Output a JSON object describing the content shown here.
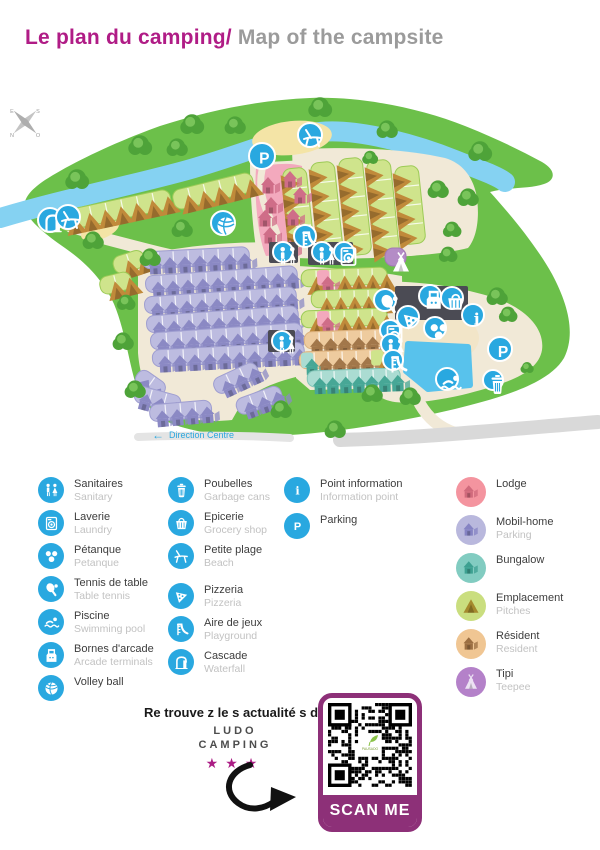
{
  "title": {
    "fr": "Le plan du camping/",
    "en": " Map of the campsite"
  },
  "colors": {
    "accent_blue": "#29a8e0",
    "land": "#6cc04a",
    "river": "#85d2f2",
    "path": "#f1e9d7",
    "sand": "#f4e4a6",
    "pool_sand": "#f2e5c8",
    "pool": "#58c2ec",
    "building": "#4b4b54",
    "road_gray": "#d9d9d9",
    "tree": "#4ea339",
    "tree_hi": "#79c45a",
    "title_magenta": "#b01c86",
    "title_gray": "#9b9b9b",
    "purple": "#8d3078",
    "star_magenta": "#ab1d85",
    "direction_blue": "#2ba7de"
  },
  "plot_types": {
    "pitch": {
      "fill": "#cfe48c",
      "stroke": "#9ccb56",
      "glyph": "#c08a3a",
      "sym": "tent"
    },
    "mobil": {
      "fill": "#bdbce0",
      "stroke": "#9f9ed0",
      "glyph": "#8b89c4",
      "sym": "house"
    },
    "lodge": {
      "fill": "#f3a9bd",
      "stroke": "#e58fa7",
      "glyph": "#cf6d88",
      "sym": "house"
    },
    "resident": {
      "fill": "#eecb9e",
      "stroke": "#ddb27e",
      "glyph": "#a2774a",
      "sym": "house"
    },
    "bungalow": {
      "fill": "#abdcd2",
      "stroke": "#83c6b8",
      "glyph": "#47a796",
      "sym": "house"
    },
    "tipi": {
      "fill": "#b48cc6",
      "stroke": "#a379b6",
      "glyph": "#ffffff",
      "sym": "tipi"
    }
  },
  "map": {
    "direction_arrow": "←",
    "direction_label": "Direction Centre",
    "compass_letters": [
      "E",
      "S",
      "N",
      "O"
    ],
    "icons": [
      {
        "name": "cascade",
        "sym": "waterfall",
        "x": 50,
        "y": 132,
        "r": 12
      },
      {
        "name": "petite-plage",
        "sym": "beachchair",
        "x": 68,
        "y": 129,
        "r": 12
      },
      {
        "name": "parking",
        "sym": "P",
        "x": 262,
        "y": 68,
        "r": 13
      },
      {
        "name": "petite-plage",
        "sym": "beachchair",
        "x": 310,
        "y": 47,
        "r": 12
      },
      {
        "name": "volley-ball",
        "sym": "volley",
        "x": 223,
        "y": 135,
        "r": 12
      },
      {
        "name": "aire-de-jeux",
        "sym": "slide",
        "x": 305,
        "y": 148,
        "r": 11
      },
      {
        "name": "sanitaires",
        "sym": "wc",
        "x": 283,
        "y": 164,
        "r": 10
      },
      {
        "name": "sanitaires",
        "sym": "wc",
        "x": 322,
        "y": 164,
        "r": 10
      },
      {
        "name": "laverie",
        "sym": "washer",
        "x": 344,
        "y": 164,
        "r": 10
      },
      {
        "name": "sanitaires",
        "sym": "wc",
        "x": 282,
        "y": 253,
        "r": 10
      },
      {
        "name": "tennis-de-table",
        "sym": "paddle",
        "x": 385,
        "y": 212,
        "r": 11
      },
      {
        "name": "bornes-arcade",
        "sym": "arcade",
        "x": 430,
        "y": 208,
        "r": 11
      },
      {
        "name": "epicerie",
        "sym": "basket",
        "x": 452,
        "y": 210,
        "r": 11
      },
      {
        "name": "pizzeria",
        "sym": "pizza",
        "x": 408,
        "y": 229,
        "r": 11
      },
      {
        "name": "point-information",
        "sym": "info",
        "x": 473,
        "y": 227,
        "r": 11
      },
      {
        "name": "laverie",
        "sym": "washer",
        "x": 390,
        "y": 242,
        "r": 10
      },
      {
        "name": "sanitaires",
        "sym": "wc",
        "x": 391,
        "y": 256,
        "r": 10
      },
      {
        "name": "aire-de-jeux",
        "sym": "slide",
        "x": 393,
        "y": 272,
        "r": 10
      },
      {
        "name": "petanque",
        "sym": "petanque",
        "x": 435,
        "y": 240,
        "r": 11
      },
      {
        "name": "piscine",
        "sym": "swimmer",
        "x": 447,
        "y": 291,
        "r": 11
      },
      {
        "name": "parking",
        "sym": "P",
        "x": 500,
        "y": 261,
        "r": 12
      },
      {
        "name": "poubelles",
        "sym": "trash",
        "x": 493,
        "y": 292,
        "r": 10
      }
    ],
    "trees": [
      [
        140,
        58,
        9
      ],
      [
        177,
        60,
        8
      ],
      [
        192,
        37,
        9
      ],
      [
        235,
        38,
        8
      ],
      [
        320,
        20,
        9
      ],
      [
        387,
        42,
        8
      ],
      [
        480,
        64,
        9
      ],
      [
        370,
        70,
        6
      ],
      [
        438,
        102,
        8
      ],
      [
        468,
        110,
        8
      ],
      [
        452,
        142,
        7
      ],
      [
        448,
        167,
        7
      ],
      [
        497,
        209,
        8
      ],
      [
        508,
        227,
        7
      ],
      [
        77,
        92,
        9
      ],
      [
        93,
        153,
        8
      ],
      [
        150,
        170,
        8
      ],
      [
        182,
        141,
        8
      ],
      [
        126,
        215,
        7
      ],
      [
        123,
        254,
        8
      ],
      [
        135,
        302,
        8
      ],
      [
        372,
        306,
        8
      ],
      [
        410,
        309,
        8
      ],
      [
        281,
        322,
        8
      ],
      [
        335,
        342,
        8
      ],
      [
        527,
        280,
        5
      ]
    ],
    "plot_rows": [
      {
        "x": 58,
        "y": 124,
        "a": -12,
        "n": 7,
        "t": "pitch",
        "w": 16,
        "h": 20
      },
      {
        "x": 172,
        "y": 103,
        "a": -14,
        "n": 5,
        "t": "pitch",
        "w": 16,
        "h": 20
      },
      {
        "x": 112,
        "y": 170,
        "a": -18,
        "n": 2,
        "t": "pitch",
        "w": 15,
        "h": 18
      },
      {
        "x": 99,
        "y": 190,
        "a": -14,
        "n": 2,
        "t": "pitch",
        "w": 15,
        "h": 18
      },
      {
        "x": 306,
        "y": 80,
        "a": 84,
        "n": 4,
        "t": "pitch",
        "w": 19,
        "h": 24
      },
      {
        "x": 334,
        "y": 74,
        "a": 84,
        "n": 5,
        "t": "pitch",
        "w": 19,
        "h": 24
      },
      {
        "x": 362,
        "y": 70,
        "a": 84,
        "n": 5,
        "t": "pitch",
        "w": 19,
        "h": 24
      },
      {
        "x": 390,
        "y": 72,
        "a": 84,
        "n": 5,
        "t": "pitch",
        "w": 19,
        "h": 24
      },
      {
        "x": 418,
        "y": 78,
        "a": 84,
        "n": 4,
        "t": "pitch",
        "w": 19,
        "h": 24
      },
      {
        "x": 143,
        "y": 164,
        "a": -3,
        "n": 7,
        "t": "mobil",
        "w": 15,
        "h": 17
      },
      {
        "x": 146,
        "y": 188,
        "a": -4,
        "n": 10,
        "t": "mobil",
        "w": 15,
        "h": 17
      },
      {
        "x": 145,
        "y": 209,
        "a": -4,
        "n": 10,
        "t": "mobil",
        "w": 15,
        "h": 17
      },
      {
        "x": 147,
        "y": 228,
        "a": -4,
        "n": 10,
        "t": "mobil",
        "w": 15,
        "h": 17
      },
      {
        "x": 151,
        "y": 245,
        "a": -4,
        "n": 10,
        "t": "mobil",
        "w": 15,
        "h": 17
      },
      {
        "x": 153,
        "y": 262,
        "a": -3,
        "n": 10,
        "t": "mobil",
        "w": 15,
        "h": 17
      },
      {
        "x": 143,
        "y": 280,
        "a": 35,
        "n": 2,
        "t": "mobil",
        "w": 15,
        "h": 17
      },
      {
        "x": 138,
        "y": 297,
        "a": 15,
        "n": 3,
        "t": "mobil",
        "w": 15,
        "h": 17
      },
      {
        "x": 150,
        "y": 317,
        "a": -5,
        "n": 4,
        "t": "mobil",
        "w": 15,
        "h": 17
      },
      {
        "x": 212,
        "y": 292,
        "a": -25,
        "n": 3,
        "t": "mobil",
        "w": 15,
        "h": 17
      },
      {
        "x": 235,
        "y": 312,
        "a": -20,
        "n": 3,
        "t": "mobil",
        "w": 15,
        "h": 17
      },
      {
        "x": 302,
        "y": 182,
        "a": -2,
        "n": 6,
        "t": "pitch",
        "w": 14,
        "h": 17,
        "acc": {
          "1": "lodge"
        }
      },
      {
        "x": 312,
        "y": 203,
        "a": -2,
        "n": 5,
        "t": "pitch",
        "w": 14,
        "h": 17
      },
      {
        "x": 302,
        "y": 223,
        "a": -2,
        "n": 6,
        "t": "pitch",
        "w": 14,
        "h": 17,
        "acc": {
          "1": "lodge"
        }
      },
      {
        "x": 305,
        "y": 244,
        "a": -2,
        "n": 6,
        "t": "resident",
        "w": 14,
        "h": 17
      },
      {
        "x": 300,
        "y": 264,
        "a": -2,
        "n": 6,
        "t": "resident",
        "w": 14,
        "h": 17,
        "acc": {
          "0": "bungalow",
          "5": "pitch"
        }
      },
      {
        "x": 308,
        "y": 283,
        "a": -2,
        "n": 7,
        "t": "bungalow",
        "w": 13,
        "h": 16
      },
      {
        "x": 386,
        "y": 160,
        "a": 0,
        "n": 1,
        "t": "tipi",
        "w": 19,
        "h": 18
      }
    ],
    "lodge_houses": [
      [
        265,
        92
      ],
      [
        287,
        86
      ],
      [
        297,
        102
      ],
      [
        268,
        112
      ],
      [
        290,
        124
      ],
      [
        299,
        139
      ],
      [
        267,
        142
      ],
      [
        287,
        155
      ],
      [
        262,
        125
      ]
    ],
    "buildings": [
      [
        269,
        154,
        29,
        21
      ],
      [
        308,
        154,
        45,
        23
      ],
      [
        268,
        242,
        27,
        22
      ],
      [
        395,
        198,
        73,
        34
      ]
    ]
  },
  "legend": {
    "columns": [
      {
        "items": [
          {
            "fr": "Sanitaires",
            "en": "Sanitary",
            "sym": "wc"
          },
          {
            "fr": "Laverie",
            "en": "Laundry",
            "sym": "washer"
          },
          {
            "fr": "Pétanque",
            "en": "Petanque",
            "sym": "petanque"
          },
          {
            "fr": "Tennis de table",
            "en": "Table tennis",
            "sym": "paddle"
          },
          {
            "fr": "Piscine",
            "en": "Swimming pool",
            "sym": "swimmer"
          },
          {
            "fr": "Bornes d'arcade",
            "en": "Arcade terminals",
            "sym": "arcade"
          },
          {
            "fr": "Volley ball",
            "en": "",
            "sym": "volley"
          }
        ]
      },
      {
        "items": [
          {
            "fr": "Poubelles",
            "en": "Garbage cans",
            "sym": "trash"
          },
          {
            "fr": "Epicerie",
            "en": "Grocery shop",
            "sym": "basket"
          },
          {
            "fr": "Petite plage",
            "en": "Beach",
            "sym": "beachchair"
          },
          {
            "fr": "Pizzeria",
            "en": "Pizzeria",
            "sym": "pizza",
            "mt": 7
          },
          {
            "fr": "Aire de jeux",
            "en": "Playground",
            "sym": "slide"
          },
          {
            "fr": "Cascade",
            "en": "Waterfall",
            "sym": "waterfall"
          }
        ]
      },
      {
        "items": [
          {
            "fr": "Point information",
            "en": "Information point",
            "sym": "info"
          },
          {
            "fr": "Parking",
            "en": "",
            "sym": "P"
          }
        ]
      },
      {
        "items": [
          {
            "fr": "Lodge",
            "en": "",
            "sym": "house",
            "color": "#f4949f",
            "glyph": "#d06a7c"
          },
          {
            "fr": "Mobil-home",
            "en": "Parking",
            "sym": "house",
            "color": "#b9b8dd",
            "glyph": "#8583c3"
          },
          {
            "fr": "Bungalow",
            "en": "",
            "sym": "house",
            "color": "#82ccc1",
            "glyph": "#3da091"
          },
          {
            "fr": "Emplacement",
            "en": "Pitches",
            "sym": "tent",
            "color": "#cade7f",
            "glyph": "#a58a2e"
          },
          {
            "fr": "Résident",
            "en": "Resident",
            "sym": "house",
            "color": "#f0c693",
            "glyph": "#9c6f42"
          },
          {
            "fr": "Tipi",
            "en": "Teepee",
            "sym": "tipi",
            "color": "#b481c9",
            "glyph": "#ece1f3"
          }
        ]
      }
    ]
  },
  "promo": {
    "heading": "Re trouve z le s actualité s du",
    "brand_line1": "LUDO",
    "brand_line2": "CAMPING",
    "stars": 3,
    "scan_label": "SCAN ME",
    "qr_logo_text": "PAUSADO"
  }
}
